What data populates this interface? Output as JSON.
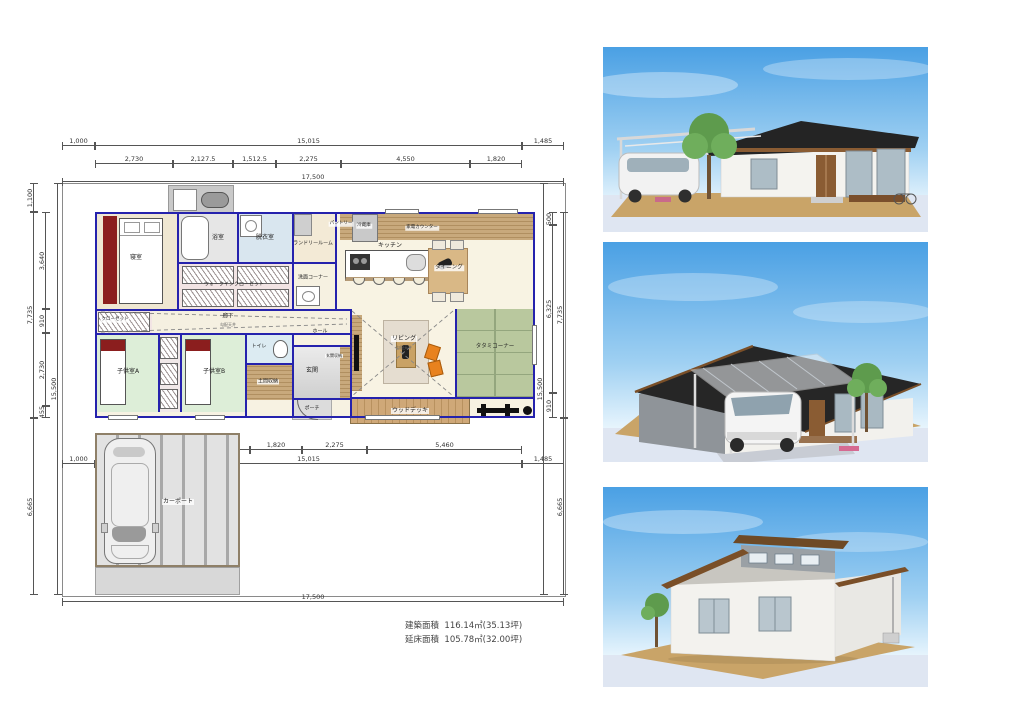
{
  "floor_plan": {
    "dims": {
      "top_row1": [
        "1,000",
        "15,015",
        "1,485"
      ],
      "top_row2": [
        "2,730",
        "2,127.5",
        "1,512.5",
        "2,275",
        "4,550",
        "1,820"
      ],
      "top_total": "17,500",
      "bottom_row1": [
        "2,426.7",
        "606.7",
        "2,426.7",
        "1,820",
        "2,275",
        "5,460"
      ],
      "bottom_row2": [
        "1,000",
        "15,015",
        "1,485"
      ],
      "bottom_total": "17,500",
      "left_outer": [
        "1,100",
        "7,735",
        "6,665"
      ],
      "left_inner": [
        "3,640",
        "910",
        "2,730",
        "455"
      ],
      "left_total": "15,500",
      "right_inner": [
        "500",
        "6,325",
        "910"
      ],
      "right_outer": [
        "7,735",
        "6,665"
      ],
      "right_total": "15,500"
    },
    "rooms": {
      "bedroom": "寝室",
      "bath": "浴室",
      "dressing": "脱衣室",
      "laundry": "ランドリールーム",
      "wic": "ウォークインクローゼット",
      "wash_corner": "洗面コーナー",
      "kitchen": "キッチン",
      "dining": "ダイニング",
      "pantry": "パントリー",
      "fridge": "冷蔵庫",
      "appliance_counter": "家電カウンター",
      "hallway": "廊下",
      "hallway_note": "勾配天井",
      "closet": "クローゼット",
      "hall": "ホール",
      "toilet": "トイレ",
      "kids_a": "子供室A",
      "kids_b": "子供室B",
      "doma_storage": "土間収納",
      "entrance": "玄関",
      "entrance_storage": "玄関収納",
      "porch": "ポーチ",
      "living": "リビング",
      "living_note": "勾配天井",
      "tatami": "タタミコーナー",
      "wood_deck": "ウッドデッキ",
      "carport": "カーポート"
    },
    "areas": {
      "building_label": "建築面積",
      "building_value": "116.14㎡(35.13坪)",
      "floor_label": "延床面積",
      "floor_value": "105.78㎡(32.00坪)"
    },
    "palette": {
      "wall_line": "#2522ad",
      "dim_line": "#555555",
      "accent_red": "#8b1e1e",
      "tatami_green": "#b9c89e",
      "wood": "#c2a276"
    }
  },
  "renders": {
    "items": [
      {
        "name": "exterior-render-front"
      },
      {
        "name": "exterior-render-side"
      },
      {
        "name": "exterior-render-rear"
      }
    ],
    "palette": {
      "sky_top": "#4aa0e4",
      "roof_dark": "#262626",
      "wall_white": "#f3f2ee",
      "ground_tan": "#c9a468",
      "wood_trim": "#7a4f28"
    }
  }
}
